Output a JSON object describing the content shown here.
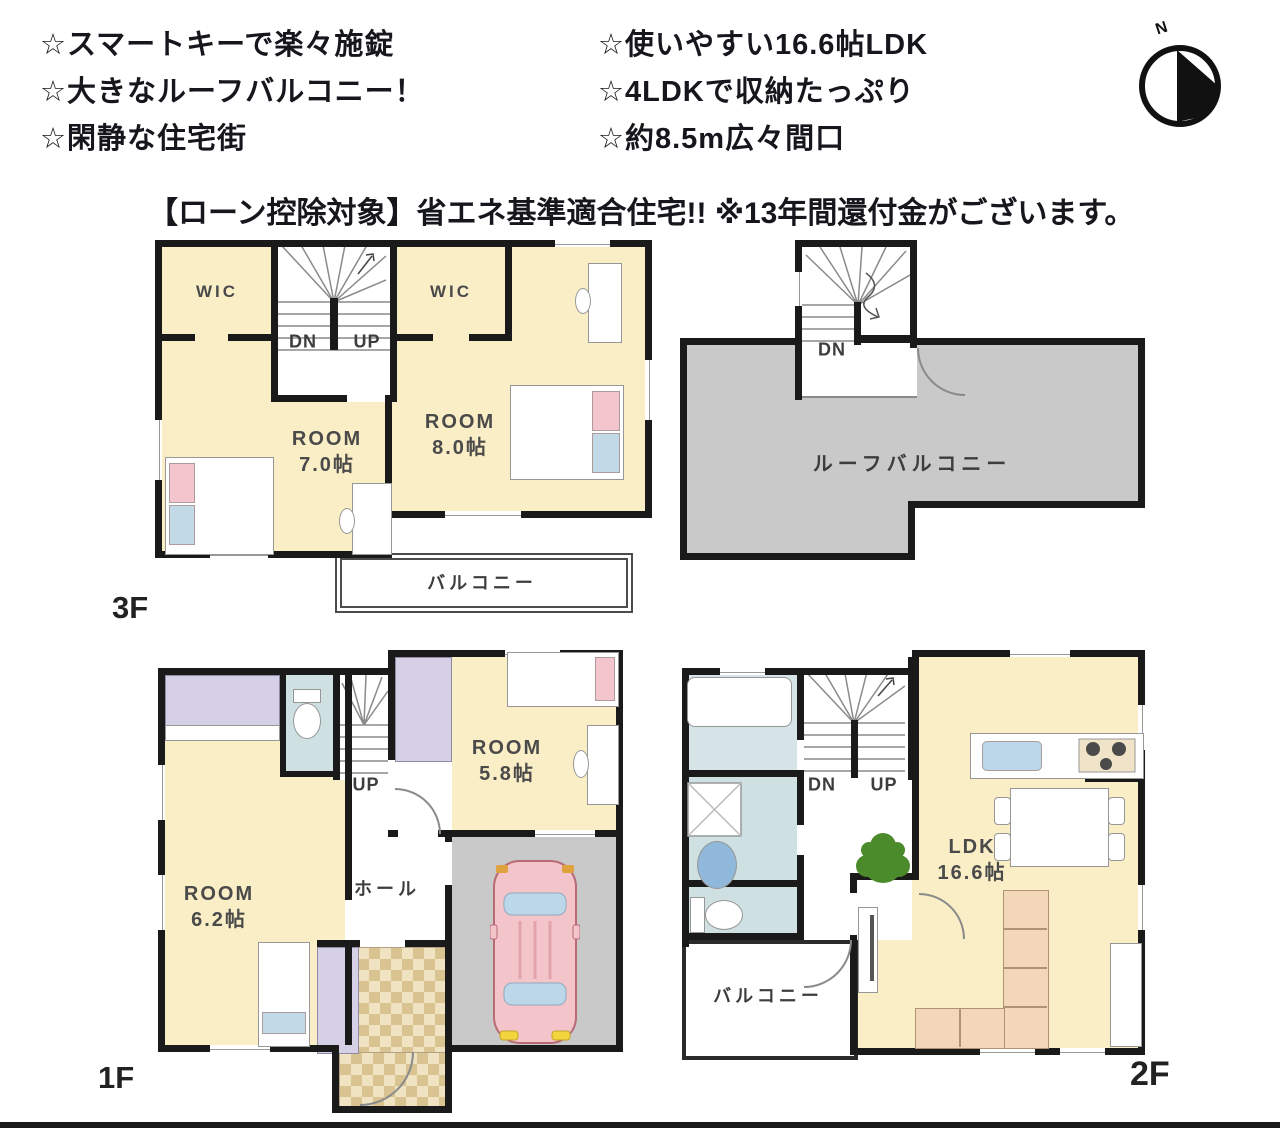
{
  "colors": {
    "wall": "#1a1a1a",
    "room_cream": "#faeec6",
    "gray_area": "#c9c9c9",
    "closet_purple": "#d6d0e6",
    "wet_blue": "#cfe0e2",
    "bath_blue": "#d7e4e7",
    "sofa_peach": "#f3d7b9",
    "car_pink": "#f3c5ca",
    "window_blue": "#bdd7ea",
    "tile_light": "#efe3c2",
    "tile_dark": "#d9c391",
    "tree_green": "#4c8b2b",
    "pillow_pink": "#f3c5cc",
    "pillow_blue": "#c2d9e8"
  },
  "header": {
    "left_bullets": [
      "☆スマートキーで楽々施錠",
      "☆大きなルーフバルコニー！",
      "☆閑静な住宅街"
    ],
    "right_bullets": [
      "☆使いやすい16.6帖LDK",
      "☆4LDKで収納たっぷり",
      "☆約8.5m広々間口"
    ],
    "compass_n": "N"
  },
  "headline": "【ローン控除対象】省エネ基準適合住宅!! ※13年間還付金がございます。",
  "plan_3f": {
    "floor_label": "3F",
    "wic_left": "WIC",
    "wic_right": "WIC",
    "stair_dn": "DN",
    "stair_up": "UP",
    "room_a": {
      "name": "ROOM",
      "size": "7.0帖"
    },
    "room_b": {
      "name": "ROOM",
      "size": "8.0帖"
    },
    "balcony": "バルコニー"
  },
  "plan_rf": {
    "stair_dn": "DN",
    "roof_balcony": "ルーフバルコニー"
  },
  "plan_1f": {
    "floor_label": "1F",
    "stair_up": "UP",
    "room_a": {
      "name": "ROOM",
      "size": "6.2帖"
    },
    "room_b": {
      "name": "ROOM",
      "size": "5.8帖"
    },
    "hall": "ホール"
  },
  "plan_2f": {
    "floor_label": "2F",
    "stair_dn": "DN",
    "stair_up": "UP",
    "ldk": {
      "name": "LDK",
      "size": "16.6帖"
    },
    "balcony": "バルコニー"
  }
}
